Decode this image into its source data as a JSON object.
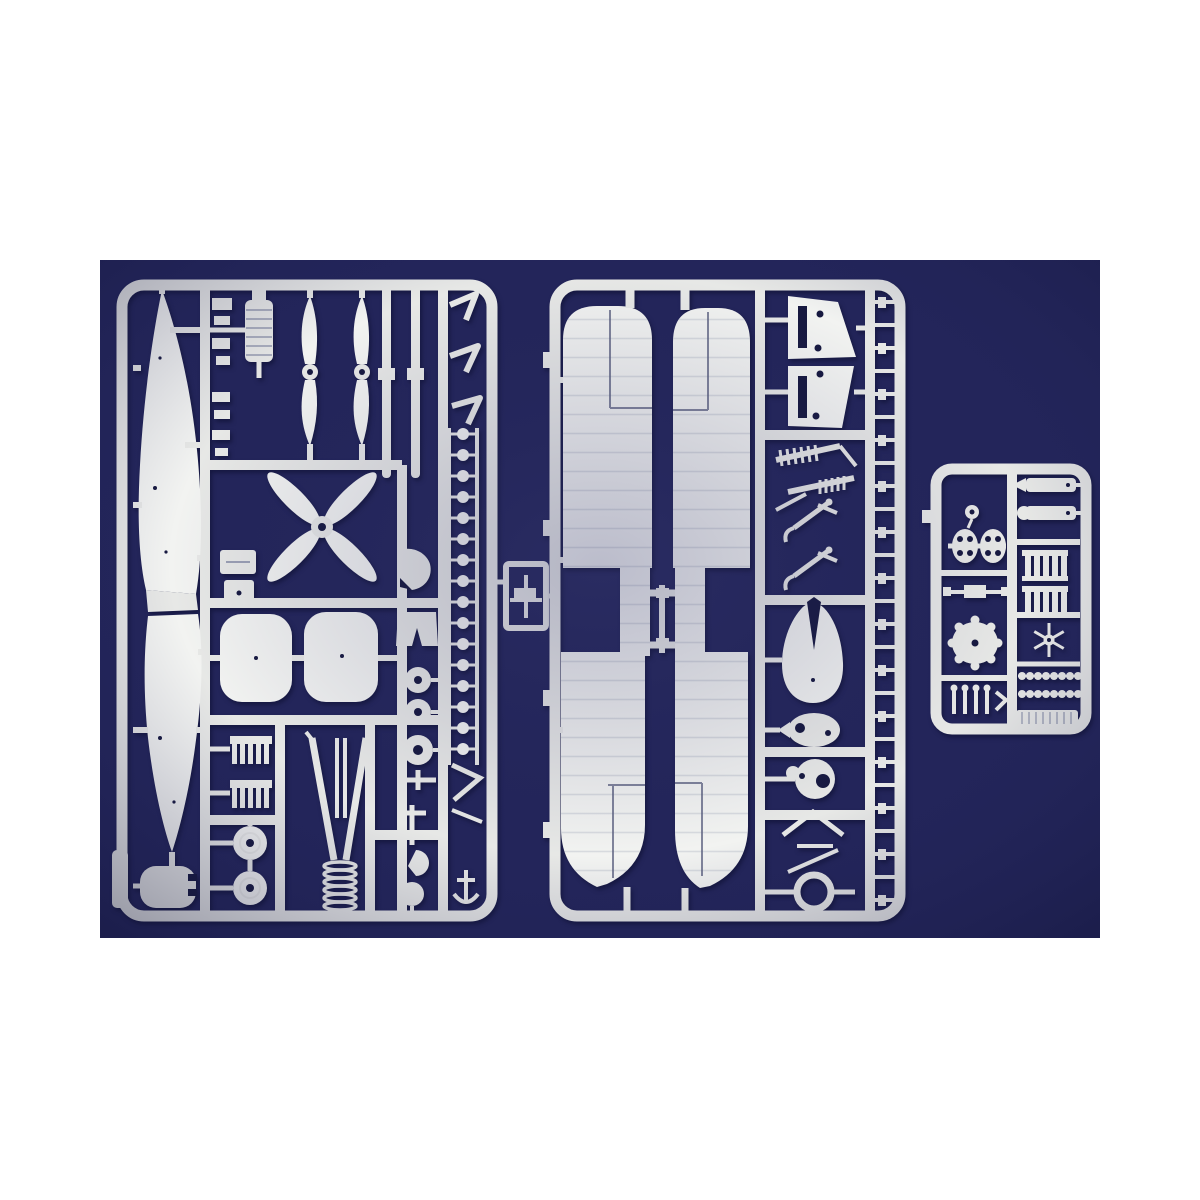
{
  "scene": {
    "description": "Photograph of three white injection-molded plastic model kit sprues with biplane aircraft parts laid on a dark navy blue background, framed by white bands above and below",
    "subject": "model-kit-sprues",
    "sprues": [
      {
        "id": "left-sprue",
        "parts": [
          "fuselage half upper",
          "fuselage half lower",
          "two-blade propeller x2",
          "four-blade propeller",
          "finned engine cylinder",
          "small fittings column",
          "tailplane panel x2",
          "radiator fin block x2",
          "wheel x2",
          "landing-gear V-strut with coil spring",
          "disc chain",
          "wing strut rods",
          "checkmark struts",
          "axle discs",
          "cowl parts",
          "fuel tank"
        ]
      },
      {
        "id": "center-sprue",
        "parts": [
          "upper wing full span",
          "lower wing full span",
          "elevator panel x2",
          "louver comb x2",
          "cabane strut hook x2",
          "teardrop fairing",
          "oval fitting",
          "round cowl plate",
          "A-frame struts",
          "cowl ring",
          "small strut ladder"
        ]
      },
      {
        "id": "right-sprue",
        "parts": [
          "knob fitting",
          "twin finned drums",
          "axle with rods",
          "engine crankcase with cylinder bumps",
          "pin row",
          "machine gun x2",
          "radiator core x2",
          "star fitting",
          "bead belt x2",
          "ribbed base plate"
        ]
      }
    ]
  },
  "colors": {
    "page": "#ffffff",
    "navy": "#23255a",
    "navy_deep": "#1a1c49",
    "hole": "#171940",
    "plastic": "#e7e8e6",
    "plastic_bright": "#f2f3f1",
    "plastic_shade": "#cfd2d6",
    "rib": "#c3c7cf",
    "cut": "#5a5f7e"
  }
}
